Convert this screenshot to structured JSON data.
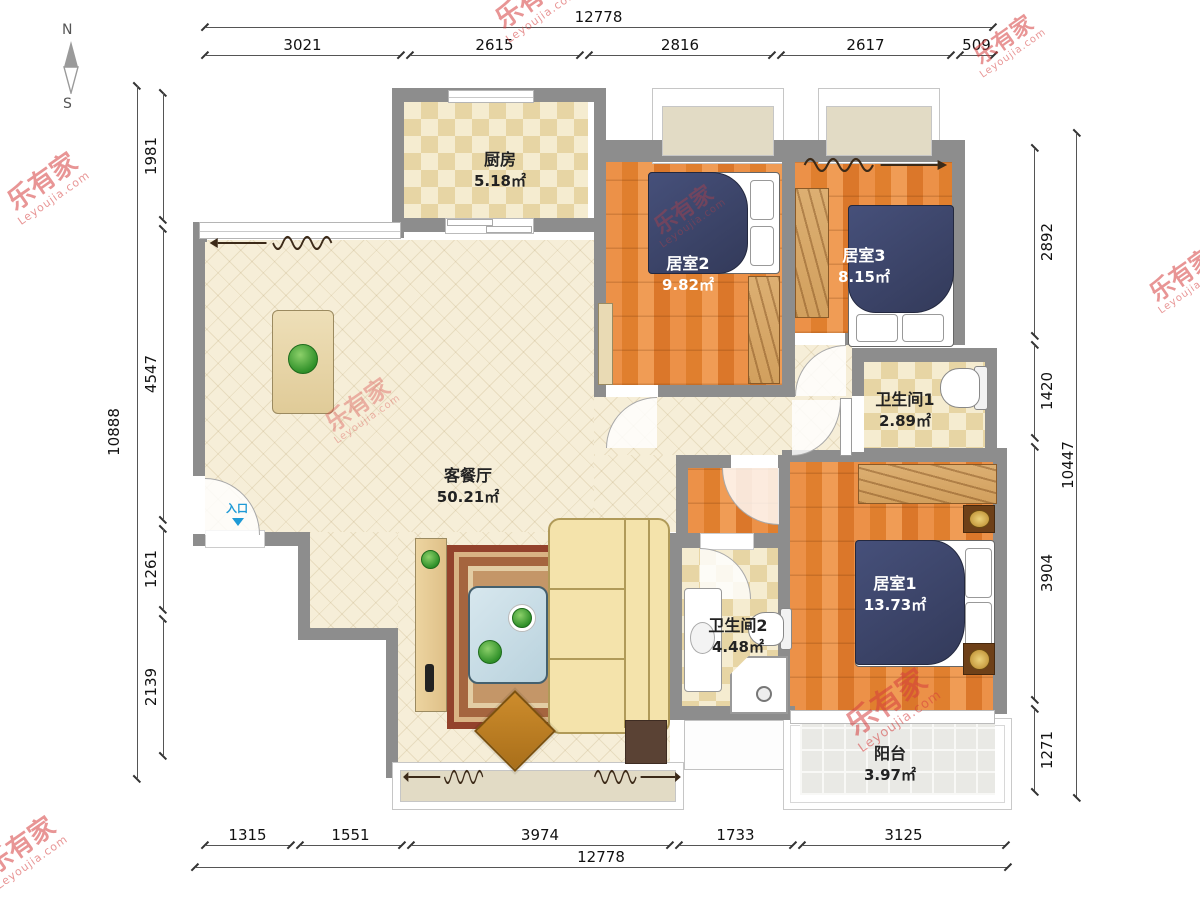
{
  "brand": {
    "name": "乐有家",
    "domain": "Leyoujia.com",
    "reg": "®"
  },
  "compass": {
    "north": "N",
    "south": "S"
  },
  "entrance_label": "入口",
  "rooms": {
    "kitchen": {
      "name": "厨房",
      "area": "5.18㎡"
    },
    "bedroom2": {
      "name": "居室2",
      "area": "9.82㎡"
    },
    "bedroom3": {
      "name": "居室3",
      "area": "8.15㎡"
    },
    "bath1": {
      "name": "卫生间1",
      "area": "2.89㎡"
    },
    "living": {
      "name": "客餐厅",
      "area": "50.21㎡"
    },
    "bath2": {
      "name": "卫生间2",
      "area": "4.48㎡"
    },
    "bedroom1": {
      "name": "居室1",
      "area": "13.73㎡"
    },
    "balcony": {
      "name": "阳台",
      "area": "3.97㎡"
    }
  },
  "dims": {
    "top": {
      "total": "12778",
      "segments": [
        "3021",
        "2615",
        "2816",
        "2617",
        "509"
      ]
    },
    "bottom": {
      "total": "12778",
      "segments": [
        "1315",
        "1551",
        "3974",
        "1733",
        "3125"
      ]
    },
    "left": {
      "total": "10888",
      "segments": [
        "1981",
        "4547",
        "1261",
        "2139"
      ]
    },
    "right": {
      "total": "10447",
      "segments": [
        "2892",
        "1420",
        "3904",
        "1271"
      ]
    }
  },
  "colors": {
    "wall": "#8d8d8d",
    "wood": "#e0812f",
    "watermark": "#d63e3e",
    "entrance": "#1e9ad6"
  }
}
